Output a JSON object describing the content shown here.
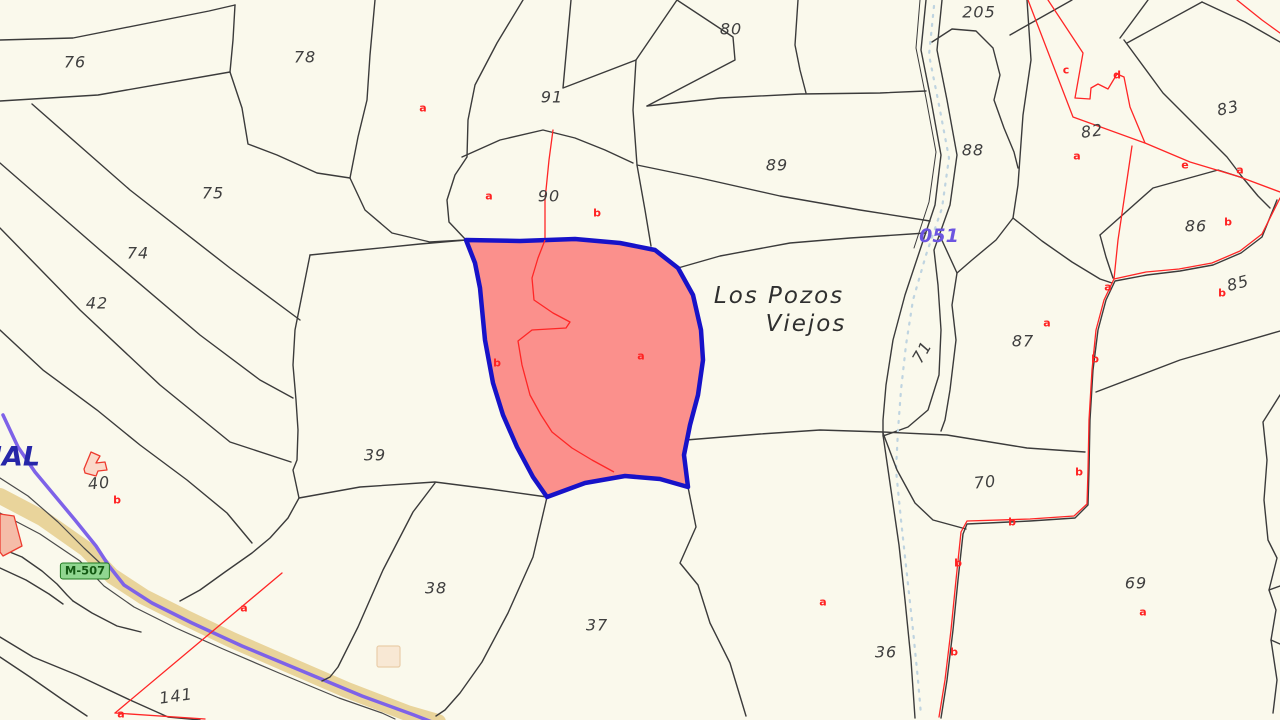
{
  "map": {
    "colors": {
      "background": "#FAF9EC",
      "parcel_line": "#3B3B3B",
      "subparcel_line": "#FF2626",
      "highlight_fill": "#FB908C",
      "highlight_border": "#1712C8",
      "road_fill": "#E9D49B",
      "road_route_line": "#7E62E8",
      "stream_dots": "#BFD4E0",
      "badge_bg": "#90D690",
      "badge_border": "#1F7A1F",
      "badge_text": "#145A14",
      "number_text": "#3F3F3F",
      "red_letter_text": "#FF2222",
      "edge_blue_text": "#2626A8",
      "stream_code_text": "#6C55E0"
    },
    "highlighted_parcel": {
      "subparcel_letters": [
        "b",
        "a"
      ],
      "fill": "#FB908C",
      "border": "#1712C8"
    }
  },
  "labels": {
    "parcel_numbers": [
      {
        "text": "76",
        "x": 75,
        "y": 62
      },
      {
        "text": "78",
        "x": 305,
        "y": 57
      },
      {
        "text": "91",
        "x": 552,
        "y": 97
      },
      {
        "text": "80",
        "x": 731,
        "y": 29
      },
      {
        "text": "205",
        "x": 979,
        "y": 12
      },
      {
        "text": "89",
        "x": 777,
        "y": 165
      },
      {
        "text": "88",
        "x": 973,
        "y": 150
      },
      {
        "text": "90",
        "x": 549,
        "y": 196
      },
      {
        "text": "82",
        "x": 1092,
        "y": 131,
        "r": -8
      },
      {
        "text": "83",
        "x": 1228,
        "y": 108,
        "r": -12
      },
      {
        "text": "86",
        "x": 1196,
        "y": 226
      },
      {
        "text": "85",
        "x": 1238,
        "y": 283,
        "r": -15
      },
      {
        "text": "87",
        "x": 1023,
        "y": 341
      },
      {
        "text": "71",
        "x": 922,
        "y": 352,
        "r": -60
      },
      {
        "text": "70",
        "x": 985,
        "y": 482,
        "r": -6
      },
      {
        "text": "69",
        "x": 1136,
        "y": 583
      },
      {
        "text": "36",
        "x": 886,
        "y": 652
      },
      {
        "text": "37",
        "x": 597,
        "y": 625
      },
      {
        "text": "38",
        "x": 436,
        "y": 588
      },
      {
        "text": "39",
        "x": 375,
        "y": 455
      },
      {
        "text": "42",
        "x": 97,
        "y": 303
      },
      {
        "text": "74",
        "x": 138,
        "y": 253
      },
      {
        "text": "75",
        "x": 213,
        "y": 193
      },
      {
        "text": "40",
        "x": 99,
        "y": 483,
        "r": -6
      },
      {
        "text": "141",
        "x": 176,
        "y": 696,
        "r": -8
      }
    ],
    "subparcel_letters": [
      {
        "text": "a",
        "x": 423,
        "y": 108
      },
      {
        "text": "a",
        "x": 489,
        "y": 196
      },
      {
        "text": "b",
        "x": 597,
        "y": 213
      },
      {
        "text": "b",
        "x": 497,
        "y": 363
      },
      {
        "text": "a",
        "x": 641,
        "y": 356
      },
      {
        "text": "c",
        "x": 1066,
        "y": 70
      },
      {
        "text": "d",
        "x": 1117,
        "y": 75
      },
      {
        "text": "a",
        "x": 1077,
        "y": 156
      },
      {
        "text": "e",
        "x": 1185,
        "y": 165
      },
      {
        "text": "a",
        "x": 1240,
        "y": 170
      },
      {
        "text": "b",
        "x": 1228,
        "y": 222
      },
      {
        "text": "b",
        "x": 1222,
        "y": 293
      },
      {
        "text": "a",
        "x": 1047,
        "y": 323
      },
      {
        "text": "a",
        "x": 1108,
        "y": 287
      },
      {
        "text": "b",
        "x": 1095,
        "y": 359
      },
      {
        "text": "b",
        "x": 1079,
        "y": 472
      },
      {
        "text": "b",
        "x": 1012,
        "y": 522
      },
      {
        "text": "b",
        "x": 958,
        "y": 563
      },
      {
        "text": "b",
        "x": 954,
        "y": 652
      },
      {
        "text": "b",
        "x": 117,
        "y": 500
      },
      {
        "text": "a",
        "x": 244,
        "y": 608
      },
      {
        "text": "a",
        "x": 121,
        "y": 714
      },
      {
        "text": "a",
        "x": 823,
        "y": 602
      },
      {
        "text": "a",
        "x": 1143,
        "y": 612
      }
    ],
    "place_names": [
      {
        "text": "Los Pozos",
        "x": 779,
        "y": 296
      },
      {
        "text": "Viejos",
        "x": 806,
        "y": 324
      }
    ],
    "stream_code": [
      {
        "text": "051",
        "x": 939,
        "y": 236
      }
    ],
    "road_badges": [
      {
        "text": "M-507",
        "x": 85,
        "y": 571
      }
    ],
    "edge_texts": [
      {
        "text": "IAL",
        "x": 16,
        "y": 457
      }
    ]
  }
}
